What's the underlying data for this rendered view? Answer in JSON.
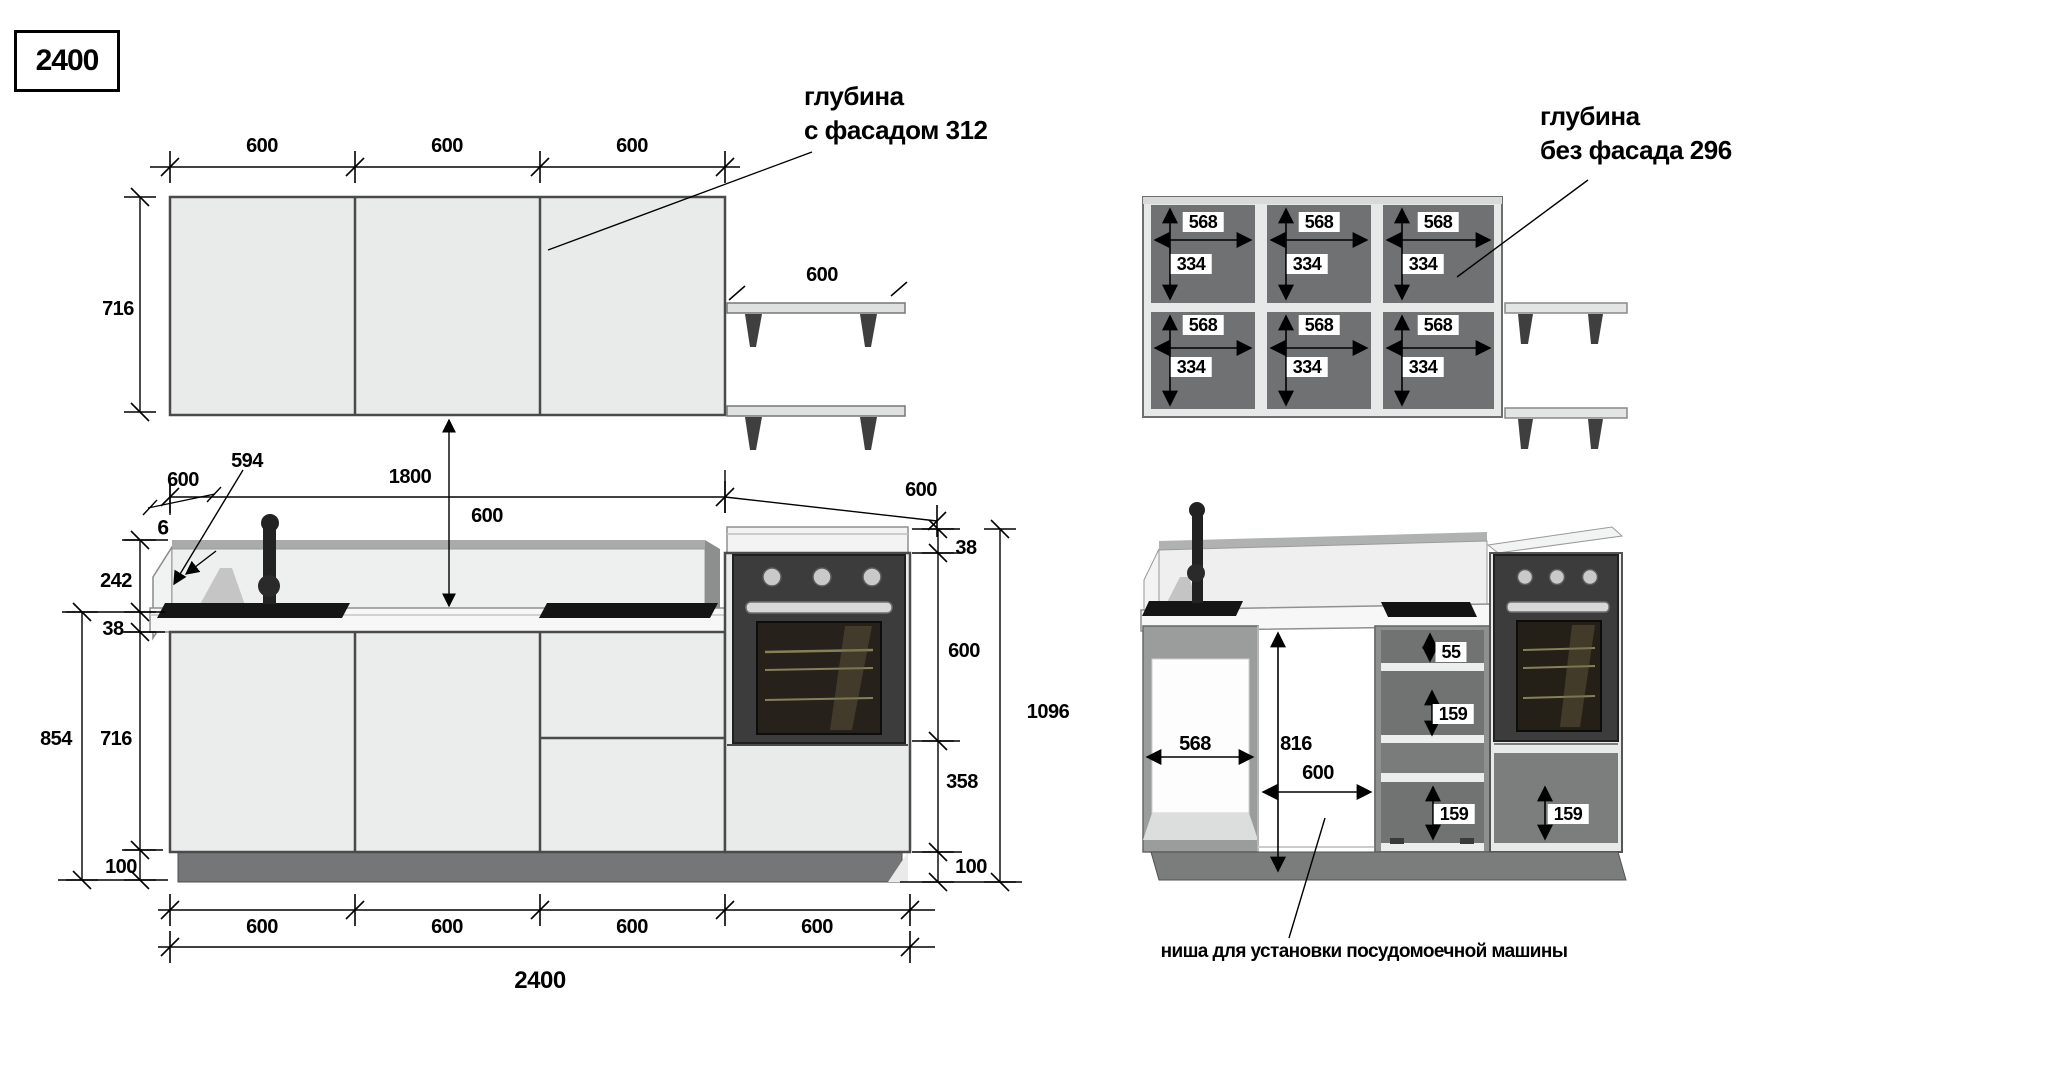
{
  "title_box": {
    "label": "2400"
  },
  "left_view": {
    "upper": {
      "door_dims": [
        "600",
        "600",
        "600"
      ],
      "height_dim": "716",
      "shelf_dim": "600",
      "depth_callout": {
        "line1": "глубина",
        "line2": "с фасадом 312"
      }
    },
    "gap_dim": "600",
    "counter": {
      "depth_dim": "600",
      "panel_dim": "594",
      "offset_dim": "6",
      "run_dim": "1800",
      "hob_section_dim": "600"
    },
    "left_chain": {
      "splash": "242",
      "worktop": "38",
      "total": "854",
      "carcass": "716",
      "plinth": "100"
    },
    "right_chain": {
      "worktop": "38",
      "oven": "600",
      "drawer": "358",
      "plinth": "100",
      "total": "1096"
    },
    "bottom": {
      "section_dims": [
        "600",
        "600",
        "600",
        "600"
      ],
      "total_dim": "2400"
    }
  },
  "right_view": {
    "upper": {
      "depth_callout": {
        "line1": "глубина",
        "line2": "без фасада 296"
      },
      "sections": [
        {
          "top_w": "568",
          "top_h": "334",
          "bottom_w": "568",
          "bottom_h": "334"
        },
        {
          "top_w": "568",
          "top_h": "334",
          "bottom_w": "568",
          "bottom_h": "334"
        },
        {
          "top_w": "568",
          "top_h": "334",
          "bottom_w": "568",
          "bottom_h": "334"
        }
      ]
    },
    "lower": {
      "sink_width": "568",
      "niche_height": "816",
      "niche_width": "600",
      "top_drawer": "55",
      "mid_drawer": "159",
      "bottom_drawer": "159",
      "oven_drawer": "159",
      "note": "ниша для установки посудомоечной машины"
    }
  }
}
